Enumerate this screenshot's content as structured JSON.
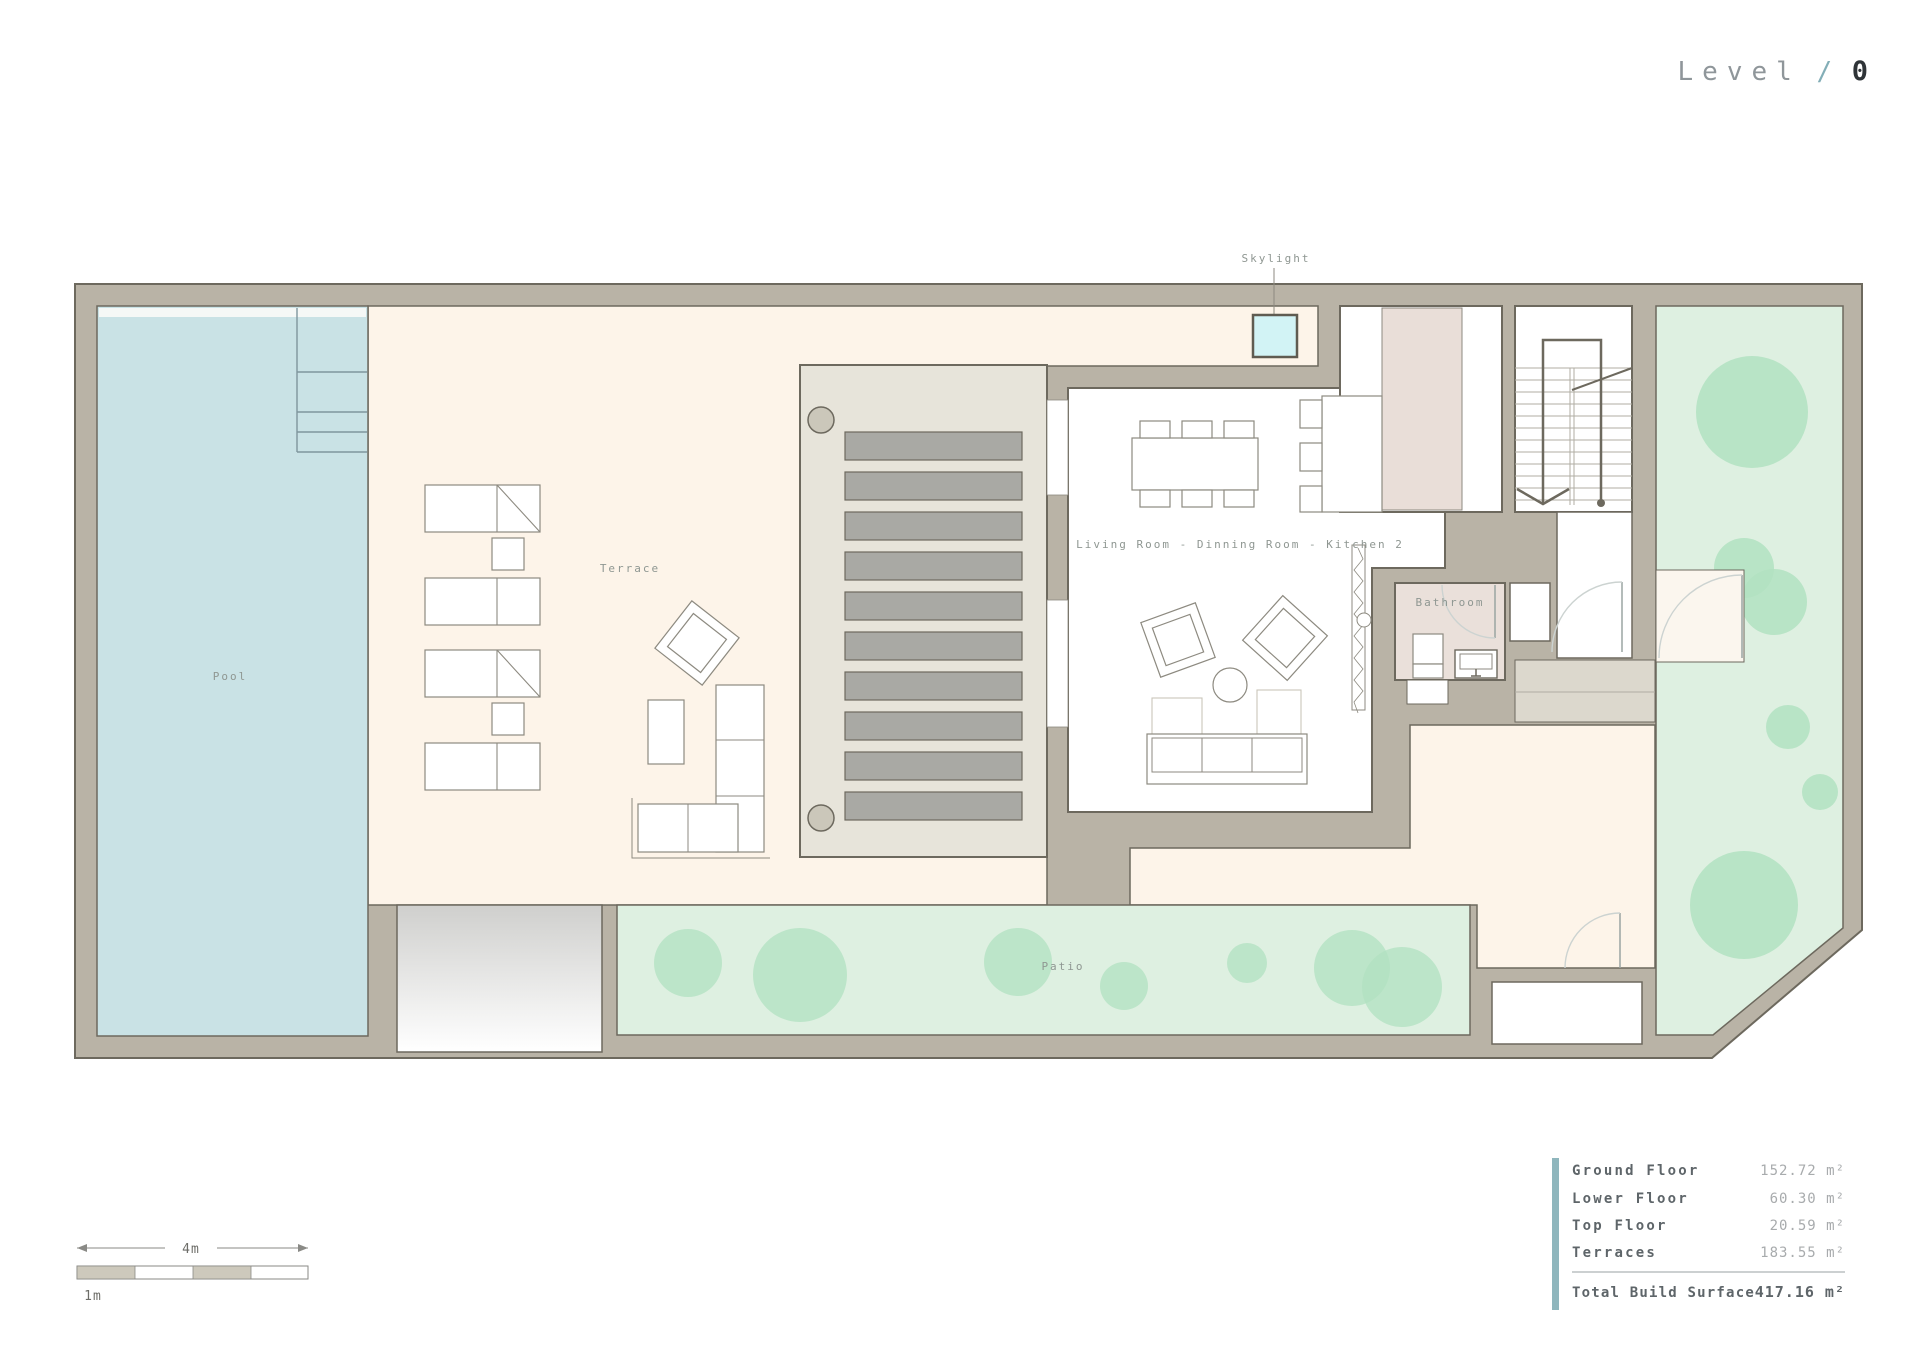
{
  "title": {
    "level_label": "Level",
    "separator": "/",
    "level_number": "0"
  },
  "plan": {
    "labels": {
      "skylight": "Skylight",
      "pool": "Pool",
      "terrace": "Terrace",
      "patio": "Patio",
      "bathroom": "Bathroom",
      "living": "Living Room - Dinning Room - Kitchen 2"
    }
  },
  "area_table": {
    "rows": [
      {
        "label": "Ground Floor",
        "value": "152.72 m²"
      },
      {
        "label": "Lower Floor",
        "value": "60.30 m²"
      },
      {
        "label": "Top Floor",
        "value": "20.59 m²"
      },
      {
        "label": "Terraces",
        "value": "183.55 m²"
      }
    ],
    "total": {
      "label": "Total Build Surface",
      "value": "417.16 m²"
    }
  },
  "scale_bar": {
    "total_label": "4m",
    "unit_label": "1m"
  },
  "colors": {
    "wall": "#b9b3a6",
    "wall_outline": "#6d695e",
    "terrace_cream": "#fdf4e9",
    "pool_blue": "#c9e2e5",
    "lawn_green": "#def0e1",
    "tree_green": "#b2e2c1",
    "slat_gray": "#a9a9a4",
    "deck_gray": "#e7e4da",
    "bathroom_pink": "#eae0da",
    "kitchen_pink": "#e9ded8",
    "skylight_cyan": "#d2f3f5",
    "accent_teal": "#8fb6bd"
  }
}
